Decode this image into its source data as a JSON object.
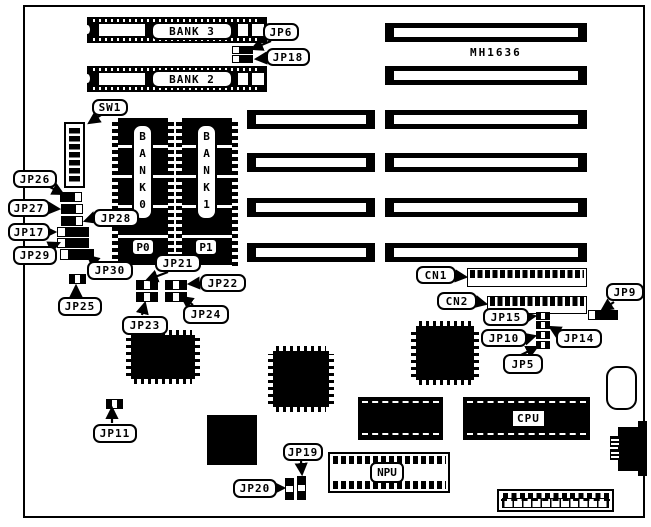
{
  "board": {
    "model": "MH1636",
    "colors": {
      "ink": "#000000",
      "bg": "#ffffff"
    }
  },
  "labels": {
    "bank3": "BANK 3",
    "bank2": "BANK 2",
    "bank0": "BANK0",
    "bank1": "BANK1",
    "p0": "P0",
    "p1": "P1",
    "sw1": "SW1",
    "jp5": "JP5",
    "jp6": "JP6",
    "jp9": "JP9",
    "jp10": "JP10",
    "jp11": "JP11",
    "jp14": "JP14",
    "jp15": "JP15",
    "jp17": "JP17",
    "jp18": "JP18",
    "jp19": "JP19",
    "jp20": "JP20",
    "jp21": "JP21",
    "jp22": "JP22",
    "jp23": "JP23",
    "jp24": "JP24",
    "jp25": "JP25",
    "jp26": "JP26",
    "jp27": "JP27",
    "jp28": "JP28",
    "jp29": "JP29",
    "jp30": "JP30",
    "cn1": "CN1",
    "cn2": "CN2",
    "cpu": "CPU",
    "npu": "NPU"
  },
  "components": {
    "simm_sockets": [
      "BANK 3",
      "BANK 2"
    ],
    "dram_banks": [
      "BANK0",
      "BANK1"
    ],
    "bank_parity_chips": [
      "P0",
      "P1"
    ],
    "dip_switches": [
      "SW1"
    ],
    "jumpers": [
      "JP5",
      "JP6",
      "JP9",
      "JP10",
      "JP11",
      "JP14",
      "JP15",
      "JP17",
      "JP18",
      "JP19",
      "JP20",
      "JP21",
      "JP22",
      "JP23",
      "JP24",
      "JP25",
      "JP26",
      "JP27",
      "JP28",
      "JP29",
      "JP30"
    ],
    "pin_headers": [
      "CN1",
      "CN2"
    ],
    "processors": [
      "CPU",
      "NPU"
    ],
    "expansion_slots": {
      "left_column_count": 4,
      "right_column_count": 6
    }
  }
}
